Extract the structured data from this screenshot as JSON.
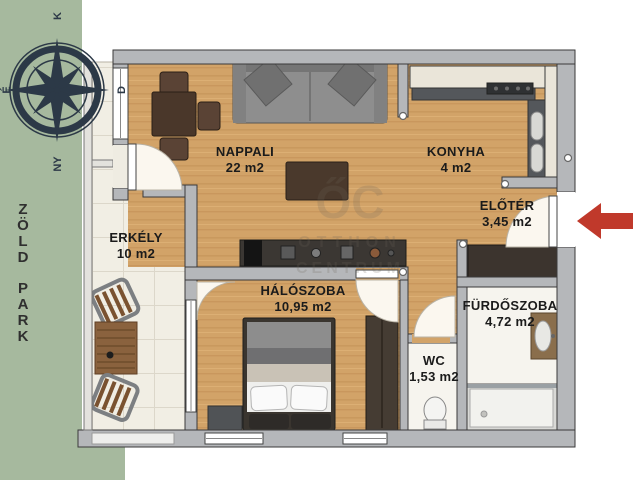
{
  "park": {
    "letters": [
      "Z",
      "Ö",
      "L",
      "D",
      "P",
      "A",
      "R",
      "K"
    ],
    "color": "#a6b99e"
  },
  "compass": {
    "north": "É",
    "east": "K",
    "south": "D",
    "west": "NY",
    "color": "#2c3947"
  },
  "watermark": {
    "logo": "ŐC",
    "line1": "OTTHON",
    "line2": "CENTRUM"
  },
  "entrance": {
    "arrow_color": "#c0392b"
  },
  "rooms": [
    {
      "name": "NAPPALI",
      "area": "22 m2"
    },
    {
      "name": "KONYHA",
      "area": "4 m2"
    },
    {
      "name": "ELŐTÉR",
      "area": "3,45 m2"
    },
    {
      "name": "ERKÉLY",
      "area": "10 m2"
    },
    {
      "name": "HÁLÓSZOBA",
      "area": "10,95 m2"
    },
    {
      "name": "WC",
      "area": "1,53 m2"
    },
    {
      "name": "FÜRDŐSZOBA",
      "area": "4,72 m2"
    }
  ],
  "colors": {
    "wall": "#b5b7ba",
    "wood": "#d2a368",
    "tile": "#f1eee4",
    "bath_floor": "#f6f4ee",
    "accent_red": "#c0392b",
    "park_green": "#a6b99e"
  }
}
